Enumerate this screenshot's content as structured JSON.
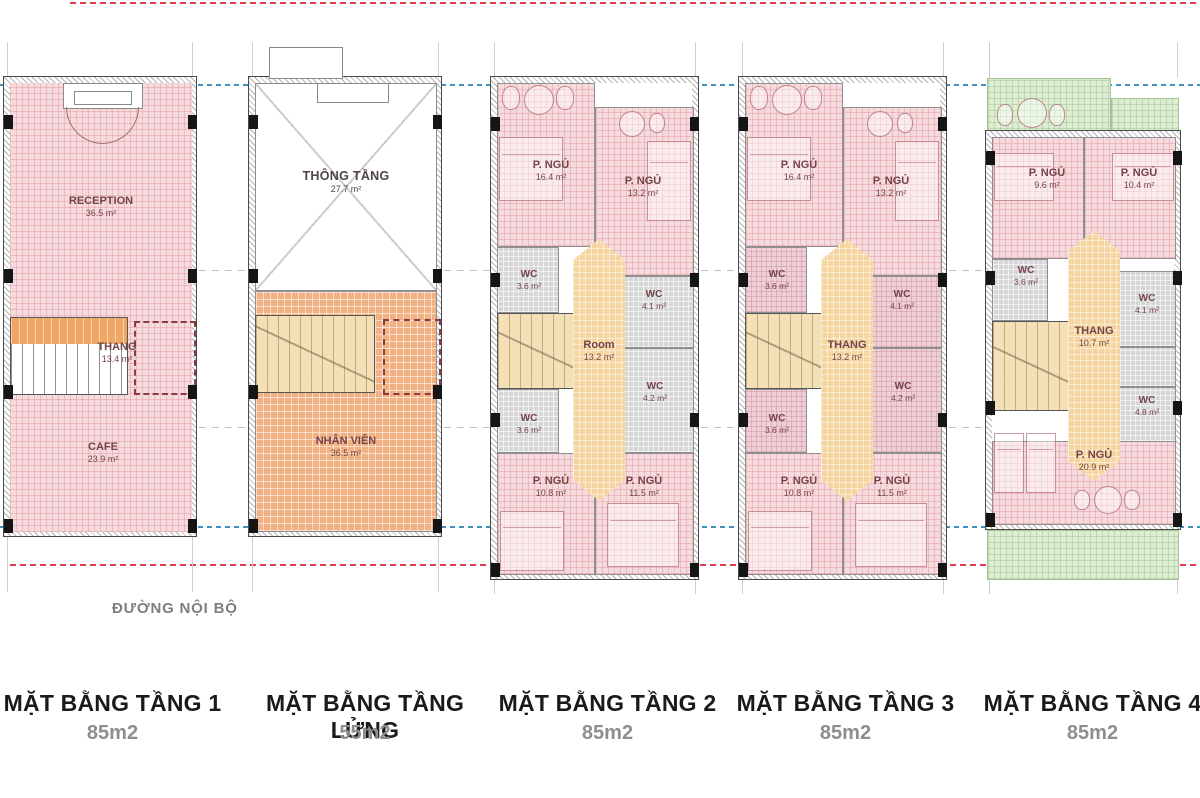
{
  "canvas": {
    "width": 1200,
    "height": 798,
    "background": "#ffffff"
  },
  "colors": {
    "room_pink": "#f6dbde",
    "staff_orange": "#f1b183",
    "stair_tan": "#f4e0b6",
    "core_amber": "#f6d6a0",
    "wc_gray": "#d7d7d7",
    "terrace_green": "#dcedd2",
    "label_maroon": "#744349",
    "boundary_line_blue": "#4090c2",
    "setback_line_red": "#e63a50"
  },
  "road_label": "ĐƯỜNG NỘI BỘ",
  "plans": [
    {
      "id": "tang-1",
      "title": "MẶT BẰNG TẦNG 1",
      "area": "85m2",
      "rooms": [
        {
          "name": "RECEPTION",
          "area": "36.5 m²"
        },
        {
          "name": "THANG",
          "area": "13.4 m²"
        },
        {
          "name": "CAFE",
          "area": "23.9 m²"
        }
      ]
    },
    {
      "id": "tang-lung",
      "title": "MẶT BẰNG TẦNG LỬNG",
      "area": "55m2",
      "rooms": [
        {
          "name": "THÔNG TẦNG",
          "area": "27.7 m²"
        },
        {
          "name": "NHÂN VIÊN",
          "area": "36.5 m²"
        }
      ]
    },
    {
      "id": "tang-2",
      "title": "MẶT BẰNG TẦNG 2",
      "area": "85m2",
      "rooms": [
        {
          "name": "P. NGỦ",
          "area": "16.4 m²"
        },
        {
          "name": "P. NGỦ",
          "area": "13.2 m²"
        },
        {
          "name": "WC",
          "area": "3.6 m²"
        },
        {
          "name": "WC",
          "area": "4.1 m²"
        },
        {
          "name": "Room",
          "area": "13.2 m²"
        },
        {
          "name": "WC",
          "area": "4.2 m²"
        },
        {
          "name": "WC",
          "area": "3.6 m²"
        },
        {
          "name": "P. NGỦ",
          "area": "10.8 m²"
        },
        {
          "name": "P. NGỦ",
          "area": "11.5 m²"
        }
      ]
    },
    {
      "id": "tang-3",
      "title": "MẶT BẰNG TẦNG 3",
      "area": "85m2",
      "rooms": [
        {
          "name": "P. NGỦ",
          "area": "16.4 m²"
        },
        {
          "name": "P. NGỦ",
          "area": "13.2 m²"
        },
        {
          "name": "WC",
          "area": "3.6 m²"
        },
        {
          "name": "WC",
          "area": "4.1 m²"
        },
        {
          "name": "THANG",
          "area": "13.2 m²"
        },
        {
          "name": "WC",
          "area": "4.2 m²"
        },
        {
          "name": "WC",
          "area": "3.6 m²"
        },
        {
          "name": "P. NGỦ",
          "area": "10.8 m²"
        },
        {
          "name": "P. NGỦ",
          "area": "11.5 m²"
        }
      ]
    },
    {
      "id": "tang-4",
      "title": "MẶT BẰNG TẦNG 4",
      "area": "85m2",
      "rooms": [
        {
          "name": "P. NGỦ",
          "area": "9.6 m²"
        },
        {
          "name": "P. NGỦ",
          "area": "10.4 m²"
        },
        {
          "name": "WC",
          "area": "3.6 m²"
        },
        {
          "name": "WC",
          "area": "4.1 m²"
        },
        {
          "name": "THANG",
          "area": "10.7 m²"
        },
        {
          "name": "WC",
          "area": "4.8 m²"
        },
        {
          "name": "P. NGỦ",
          "area": "20.9 m²"
        }
      ]
    }
  ]
}
